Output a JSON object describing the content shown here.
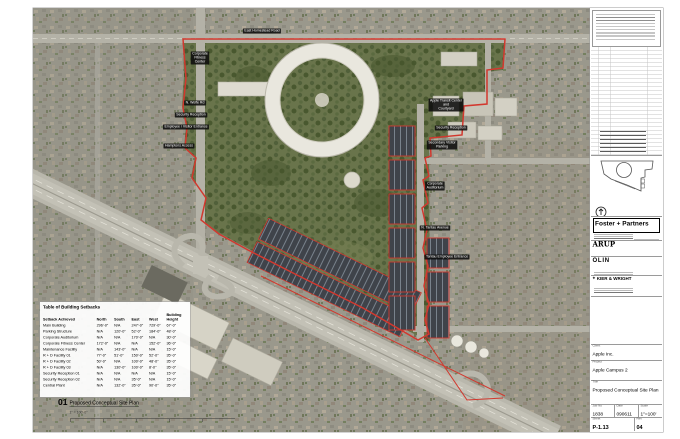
{
  "colors": {
    "boundary_red": "#d2382e",
    "label_bg": "#0c0c0c"
  },
  "map": {
    "labels": [
      {
        "text": "East Homestead Road",
        "x": 229,
        "y": 23
      },
      {
        "text": "Corporate\nFitness\nCenter",
        "x": 167,
        "y": 50
      },
      {
        "text": "N. Wolfe Rd",
        "x": 162,
        "y": 95
      },
      {
        "text": "Security Reception",
        "x": 158,
        "y": 107
      },
      {
        "text": "Employee / Visitor Entrance",
        "x": 153,
        "y": 119
      },
      {
        "text": "Hamptons Access",
        "x": 146,
        "y": 138
      },
      {
        "text": "Apple Transit Center\nand\nCourtyard",
        "x": 413,
        "y": 97
      },
      {
        "text": "Security Reception",
        "x": 418,
        "y": 120
      },
      {
        "text": "Secondary Visitor\nParking",
        "x": 409,
        "y": 137
      },
      {
        "text": "Corporate\nAuditorium",
        "x": 402,
        "y": 178
      },
      {
        "text": "N. Tantau Avenue",
        "x": 402,
        "y": 220
      },
      {
        "text": "Tantau Employee Entrance",
        "x": 414,
        "y": 249
      }
    ],
    "setbacks": {
      "title": "Table of Building Setbacks",
      "columns": [
        "Setback Achieved",
        "North",
        "South",
        "East",
        "West",
        "Building Height"
      ],
      "rows": [
        [
          "Main Building",
          "296'-0\"",
          "N/A",
          "247'-0\"",
          "729'-0\"",
          "67'-0\""
        ],
        [
          "Parking Structure",
          "N/A",
          "120'-0\"",
          "52'-0\"",
          "184'-0\"",
          "48'-0\""
        ],
        [
          "Corporate Auditorium",
          "N/A",
          "N/A",
          "170'-0\"",
          "N/A",
          "30'-0\""
        ],
        [
          "Corporate Fitness Center",
          "172'-0\"",
          "N/A",
          "N/A",
          "152'-0\"",
          "36'-0\""
        ],
        [
          "Maintenance Facility",
          "N/A",
          "143'-0\"",
          "N/A",
          "N/A",
          "15'-0\""
        ],
        [
          "R + D Facility 01",
          "77'-0\"",
          "51'-0\"",
          "150'-0\"",
          "52'-0\"",
          "35'-0\""
        ],
        [
          "R + D Facility 02",
          "50'-0\"",
          "N/A",
          "100'-0\"",
          "48'-0\"",
          "35'-0\""
        ],
        [
          "R + D Facility 03",
          "N/A",
          "130'-0\"",
          "100'-0\"",
          "8'-0\"",
          "35'-0\""
        ],
        [
          "Security Reception 01",
          "N/A",
          "N/A",
          "N/A",
          "N/A",
          "15'-0\""
        ],
        [
          "Security Reception 02",
          "N/A",
          "N/A",
          "35'-0\"",
          "N/A",
          "15'-0\""
        ],
        [
          "Central Plant",
          "N/A",
          "132'-0\"",
          "35'-0\"",
          "90'-0\"",
          "35'-0\""
        ]
      ]
    },
    "drawing_label": {
      "number": "01",
      "title": "Proposed Conceptual Site Plan",
      "scale": "1\" = 100'-0\""
    }
  },
  "titleblock": {
    "firm": "Foster + Partners",
    "arup": "ARUP",
    "olin": "OLIN",
    "kier_wright": "KIER & WRIGHT",
    "client_label": "Client",
    "client": "Apple Inc.",
    "project_label": "Project",
    "project": "Apple Campus 2",
    "title_label": "Title",
    "sheet_title": "Proposed Conceptual Site Plan",
    "job_label": "Job No",
    "job": "1838",
    "date_label": "Date",
    "date": "090611",
    "scale_label": "Scale",
    "scale": "1\"=100'",
    "sheet_label": "Sheet",
    "sheet_no": "P-1.13",
    "rev_label": "Rev",
    "rev": "04"
  }
}
